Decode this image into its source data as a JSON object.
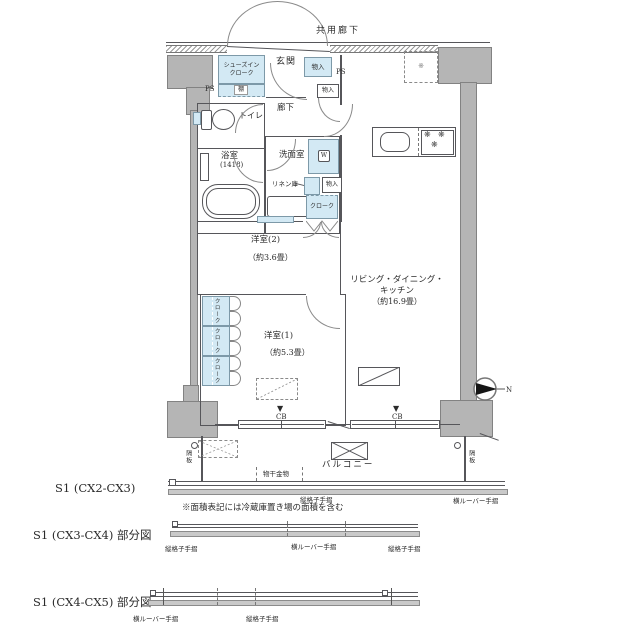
{
  "colors": {
    "storage_blue": "#d3e9f4",
    "concrete_gray": "#b5b5b5",
    "line": "#56565a"
  },
  "labels": {
    "common_corridor": "共用廊下",
    "entrance": "玄関",
    "sic_line1": "シューズイン",
    "sic_line2": "クローク",
    "shelf": "棚",
    "ps_left": "PS",
    "ps_right": "PS",
    "storage_entry": "物入",
    "storage_entry_small": "物入",
    "toilet": "トイレ",
    "corridor": "廊下",
    "bath": "浴室",
    "bath_size": "(1418)",
    "washroom": "洗面室",
    "washer": "W",
    "linen": "リネン庫",
    "storage_mid": "物入",
    "cloak_entry": "クローク",
    "fridge_mark": "※",
    "ldk_line1": "リビング・ダイニング・",
    "ldk_line2": "キッチン",
    "ldk_size": "（約16.9畳）",
    "room2": "洋室(2)",
    "room2_size": "（約3.6畳）",
    "room1": "洋室(1)",
    "room1_size": "（約5.3畳）",
    "cloak1": "クローク",
    "cloak2": "クローク",
    "cloak3": "クローク",
    "cb_arrow1": "▼",
    "cb1": "CB",
    "cb_arrow2": "▼",
    "cb2": "CB",
    "balcony": "バルコニー",
    "partition_left": "隔板",
    "partition_right": "隔板",
    "laundry": "物干金物",
    "burner1": "❋",
    "burner2": "❋",
    "burner3": "❋",
    "north": "N"
  },
  "rails": {
    "fig1_center": "縦格子手摺",
    "fig1_right": "横ルーバー手摺",
    "fig2_left": "縦格子手摺",
    "fig2_center": "横ルーバー手摺",
    "fig2_right": "縦格子手摺",
    "fig3_left": "横ルーバー手摺",
    "fig3_center": "縦格子手摺"
  },
  "sections": {
    "s1": "S1 (CX2-CX3)",
    "s2": "S1 (CX3-CX4) 部分図",
    "s3": "S1 (CX4-CX5) 部分図",
    "note": "※面積表記には冷蔵庫置き場の面積を含む"
  }
}
